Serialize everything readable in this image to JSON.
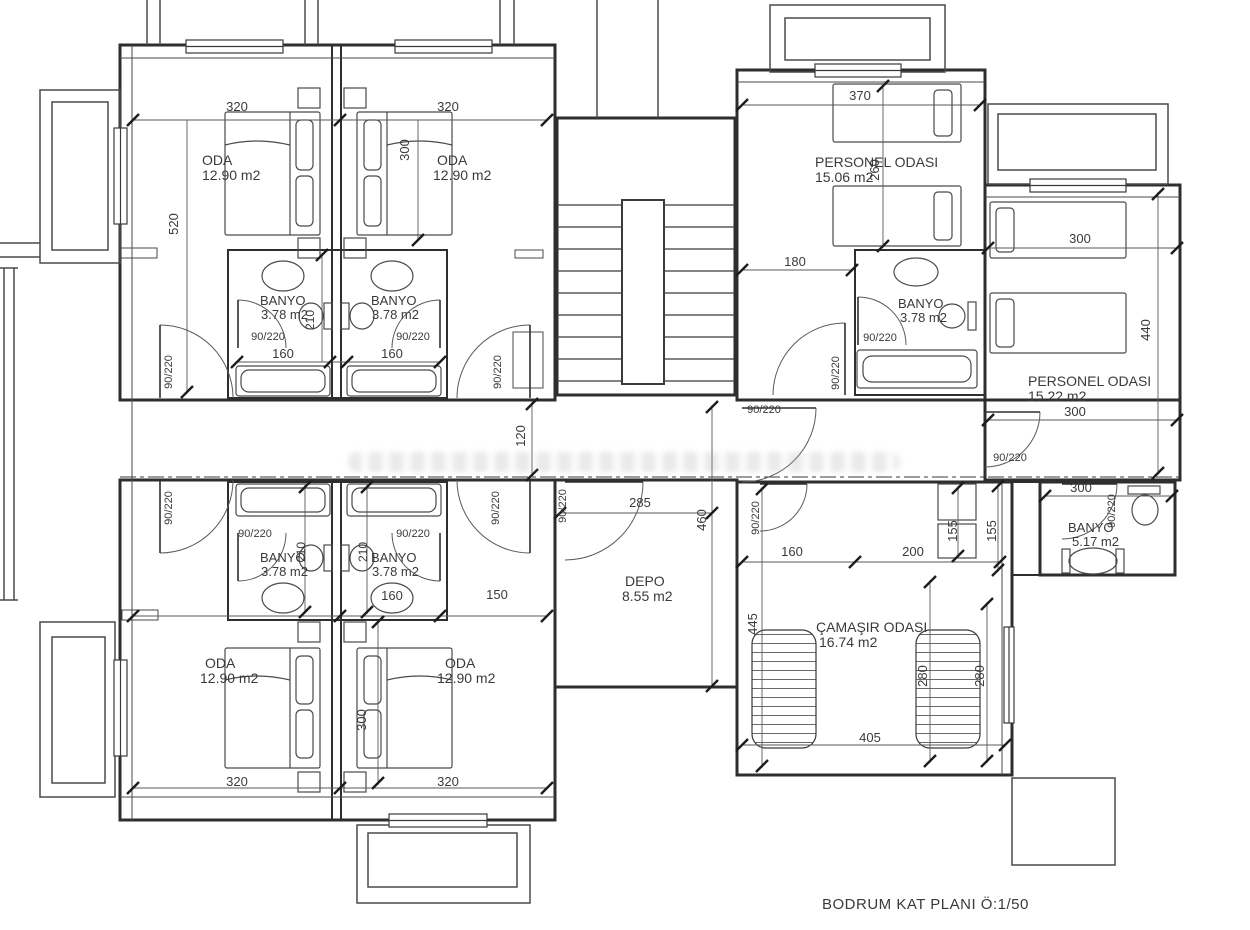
{
  "title": "BODRUM KAT PLANI Ö:1/50",
  "plan": {
    "floor_name": "BODRUM KAT PLANI",
    "scale": "Ö:1/50",
    "door_spec": "90/220"
  },
  "rooms": [
    {
      "label": "ODA",
      "area": "12.90 m2"
    },
    {
      "label": "ODA",
      "area": "12.90 m2"
    },
    {
      "label": "ODA",
      "area": "12.90 m2"
    },
    {
      "label": "ODA",
      "area": "12.90 m2"
    },
    {
      "label": "BANYO",
      "area": "3.78 m2"
    },
    {
      "label": "BANYO",
      "area": "3.78 m2"
    },
    {
      "label": "BANYO",
      "area": "3.78 m2"
    },
    {
      "label": "BANYO",
      "area": "3.78 m2"
    },
    {
      "label": "BANYO",
      "area": "3.78 m2"
    },
    {
      "label": "BANYO",
      "area": "5.17 m2"
    },
    {
      "label": "PERSONEL ODASI",
      "area": "15.06 m2"
    },
    {
      "label": "PERSONEL ODASI",
      "area": "15.22 m2"
    },
    {
      "label": "DEPO",
      "area": "8.55 m2"
    },
    {
      "label": "ÇAMAŞIR ODASI",
      "area": "16.74 m2"
    }
  ],
  "labels": [
    {
      "name": "dim-320-top-left",
      "text": "320",
      "x": 237,
      "y": 111
    },
    {
      "name": "dim-320-top-right",
      "text": "320",
      "x": 448,
      "y": 111
    },
    {
      "name": "dim-300-top",
      "text": "300",
      "x": 409,
      "y": 150,
      "rot": -90
    },
    {
      "name": "dim-520-left",
      "text": "520",
      "x": 178,
      "y": 224,
      "rot": -90
    },
    {
      "name": "room-oda1-name",
      "text": "ODA",
      "x": 202,
      "y": 165,
      "anchor": "start",
      "size": 14
    },
    {
      "name": "room-oda1-area",
      "text": "12.90 m2",
      "x": 202,
      "y": 180,
      "anchor": "start",
      "size": 14
    },
    {
      "name": "room-oda2-name",
      "text": "ODA",
      "x": 437,
      "y": 165,
      "anchor": "start",
      "size": 14
    },
    {
      "name": "room-oda2-area",
      "text": "12.90 m2",
      "x": 433,
      "y": 180,
      "anchor": "start",
      "size": 14
    },
    {
      "name": "room-banyo1-name",
      "text": "BANYO",
      "x": 260,
      "y": 305,
      "anchor": "start"
    },
    {
      "name": "room-banyo1-area",
      "text": "3.78 m2",
      "x": 261,
      "y": 319,
      "anchor": "start"
    },
    {
      "name": "room-banyo2-name",
      "text": "BANYO",
      "x": 371,
      "y": 305,
      "anchor": "start"
    },
    {
      "name": "room-banyo2-area",
      "text": "3.78 m2",
      "x": 372,
      "y": 319,
      "anchor": "start"
    },
    {
      "name": "dim-210-top",
      "text": "210",
      "x": 314,
      "y": 320,
      "rot": -90,
      "size": 12
    },
    {
      "name": "door-banyo1",
      "text": "90/220",
      "x": 268,
      "y": 340,
      "size": 11
    },
    {
      "name": "door-banyo2",
      "text": "90/220",
      "x": 413,
      "y": 340,
      "size": 11
    },
    {
      "name": "dim-160-banyo1",
      "text": "160",
      "x": 283,
      "y": 358
    },
    {
      "name": "dim-160-banyo2",
      "text": "160",
      "x": 392,
      "y": 358
    },
    {
      "name": "door-oda1",
      "text": "90/220",
      "x": 172,
      "y": 372,
      "rot": -90,
      "size": 11
    },
    {
      "name": "door-oda2",
      "text": "90/220",
      "x": 501,
      "y": 372,
      "rot": -90,
      "size": 11
    },
    {
      "name": "dim-120-corridor",
      "text": "120",
      "x": 525,
      "y": 436,
      "rot": -90
    },
    {
      "name": "door-depo",
      "text": "90/220",
      "x": 566,
      "y": 506,
      "rot": -90,
      "size": 11
    },
    {
      "name": "dim-285-depo",
      "text": "285",
      "x": 640,
      "y": 507
    },
    {
      "name": "dim-460-depo",
      "text": "460",
      "x": 706,
      "y": 520,
      "rot": -90
    },
    {
      "name": "room-depo-name",
      "text": "DEPO",
      "x": 625,
      "y": 586,
      "anchor": "start",
      "size": 14
    },
    {
      "name": "room-depo-area",
      "text": "8.55 m2",
      "x": 622,
      "y": 601,
      "anchor": "start",
      "size": 14
    },
    {
      "name": "door-oda3",
      "text": "90/220",
      "x": 172,
      "y": 508,
      "rot": -90,
      "size": 11
    },
    {
      "name": "door-oda4",
      "text": "90/220",
      "x": 499,
      "y": 508,
      "rot": -90,
      "size": 11
    },
    {
      "name": "door-banyo3",
      "text": "90/220",
      "x": 255,
      "y": 537,
      "size": 11
    },
    {
      "name": "door-banyo4",
      "text": "90/220",
      "x": 413,
      "y": 537,
      "size": 11
    },
    {
      "name": "dim-210-bottom-a",
      "text": "210",
      "x": 305,
      "y": 552,
      "rot": -90,
      "size": 12
    },
    {
      "name": "dim-210-bottom-b",
      "text": "210",
      "x": 367,
      "y": 552,
      "rot": -90,
      "size": 12
    },
    {
      "name": "room-banyo3-name",
      "text": "BANYO",
      "x": 260,
      "y": 562,
      "anchor": "start"
    },
    {
      "name": "room-banyo3-area",
      "text": "3.78 m2",
      "x": 261,
      "y": 576,
      "anchor": "start"
    },
    {
      "name": "room-banyo4-name",
      "text": "BANYO",
      "x": 371,
      "y": 562,
      "anchor": "start"
    },
    {
      "name": "room-banyo4-area",
      "text": "3.78 m2",
      "x": 372,
      "y": 576,
      "anchor": "start"
    },
    {
      "name": "dim-160-bottom",
      "text": "160",
      "x": 392,
      "y": 600
    },
    {
      "name": "dim-150-bottom",
      "text": "150",
      "x": 497,
      "y": 599
    },
    {
      "name": "room-oda3-name",
      "text": "ODA",
      "x": 205,
      "y": 668,
      "anchor": "start",
      "size": 14
    },
    {
      "name": "room-oda3-area",
      "text": "12.90 m2",
      "x": 200,
      "y": 683,
      "anchor": "start",
      "size": 14
    },
    {
      "name": "room-oda4-name",
      "text": "ODA",
      "x": 445,
      "y": 668,
      "anchor": "start",
      "size": 14
    },
    {
      "name": "room-oda4-area",
      "text": "12.90 m2",
      "x": 437,
      "y": 683,
      "anchor": "start",
      "size": 14
    },
    {
      "name": "dim-300-bottom",
      "text": "300",
      "x": 366,
      "y": 720,
      "rot": -90
    },
    {
      "name": "dim-320-bottom-left",
      "text": "320",
      "x": 237,
      "y": 786
    },
    {
      "name": "dim-320-bottom-right",
      "text": "320",
      "x": 448,
      "y": 786
    },
    {
      "name": "dim-370",
      "text": "370",
      "x": 860,
      "y": 100
    },
    {
      "name": "room-personel1-name",
      "text": "PERSONEL ODASI",
      "x": 815,
      "y": 167,
      "anchor": "start",
      "size": 14
    },
    {
      "name": "room-personel1-area",
      "text": "15.06 m2",
      "x": 815,
      "y": 182,
      "anchor": "start",
      "size": 14
    },
    {
      "name": "dim-260",
      "text": "260",
      "x": 879,
      "y": 170,
      "rot": -90
    },
    {
      "name": "dim-180",
      "text": "180",
      "x": 795,
      "y": 266
    },
    {
      "name": "room-banyo5-name",
      "text": "BANYO",
      "x": 898,
      "y": 308,
      "anchor": "start"
    },
    {
      "name": "room-banyo5-area",
      "text": "3.78 m2",
      "x": 900,
      "y": 322,
      "anchor": "start"
    },
    {
      "name": "door-banyo5",
      "text": "90/220",
      "x": 880,
      "y": 341,
      "size": 11
    },
    {
      "name": "door-personel1",
      "text": "90/220",
      "x": 839,
      "y": 373,
      "rot": -90,
      "size": 11
    },
    {
      "name": "door-corridor-right",
      "text": "90/220",
      "x": 764,
      "y": 413,
      "size": 11
    },
    {
      "name": "dim-300-personel2-top",
      "text": "300",
      "x": 1080,
      "y": 243
    },
    {
      "name": "dim-440",
      "text": "440",
      "x": 1150,
      "y": 330,
      "rot": -90
    },
    {
      "name": "room-personel2-name",
      "text": "PERSONEL ODASI",
      "x": 1028,
      "y": 386,
      "anchor": "start",
      "size": 14
    },
    {
      "name": "room-personel2-area",
      "text": "15.22 m2",
      "x": 1028,
      "y": 401,
      "anchor": "start",
      "size": 14
    },
    {
      "name": "dim-300-hall",
      "text": "300",
      "x": 1075,
      "y": 416
    },
    {
      "name": "door-hall",
      "text": "90/220",
      "x": 1010,
      "y": 461,
      "size": 11
    },
    {
      "name": "dim-300-banyo6",
      "text": "300",
      "x": 1081,
      "y": 492
    },
    {
      "name": "door-banyo6",
      "text": "90/220",
      "x": 1115,
      "y": 511,
      "rot": -90,
      "size": 11
    },
    {
      "name": "room-banyo6-name",
      "text": "BANYO",
      "x": 1068,
      "y": 532,
      "anchor": "start"
    },
    {
      "name": "room-banyo6-area",
      "text": "5.17 m2",
      "x": 1072,
      "y": 546,
      "anchor": "start"
    },
    {
      "name": "door-laundry",
      "text": "90/220",
      "x": 759,
      "y": 518,
      "rot": -90,
      "size": 11
    },
    {
      "name": "dim-155-a",
      "text": "155",
      "x": 957,
      "y": 531,
      "rot": -90
    },
    {
      "name": "dim-155-b",
      "text": "155",
      "x": 996,
      "y": 531,
      "rot": -90
    },
    {
      "name": "dim-160-laundry",
      "text": "160",
      "x": 792,
      "y": 556
    },
    {
      "name": "dim-200-laundry",
      "text": "200",
      "x": 913,
      "y": 556
    },
    {
      "name": "dim-445",
      "text": "445",
      "x": 757,
      "y": 624,
      "rot": -90
    },
    {
      "name": "room-laundry-name",
      "text": "ÇAMAŞIR ODASI",
      "x": 816,
      "y": 632,
      "anchor": "start",
      "size": 14
    },
    {
      "name": "room-laundry-area",
      "text": "16.74 m2",
      "x": 819,
      "y": 647,
      "anchor": "start",
      "size": 14
    },
    {
      "name": "dim-280-a",
      "text": "280",
      "x": 927,
      "y": 676,
      "rot": -90
    },
    {
      "name": "dim-280-b",
      "text": "280",
      "x": 984,
      "y": 676,
      "rot": -90
    },
    {
      "name": "dim-405",
      "text": "405",
      "x": 870,
      "y": 742
    }
  ]
}
